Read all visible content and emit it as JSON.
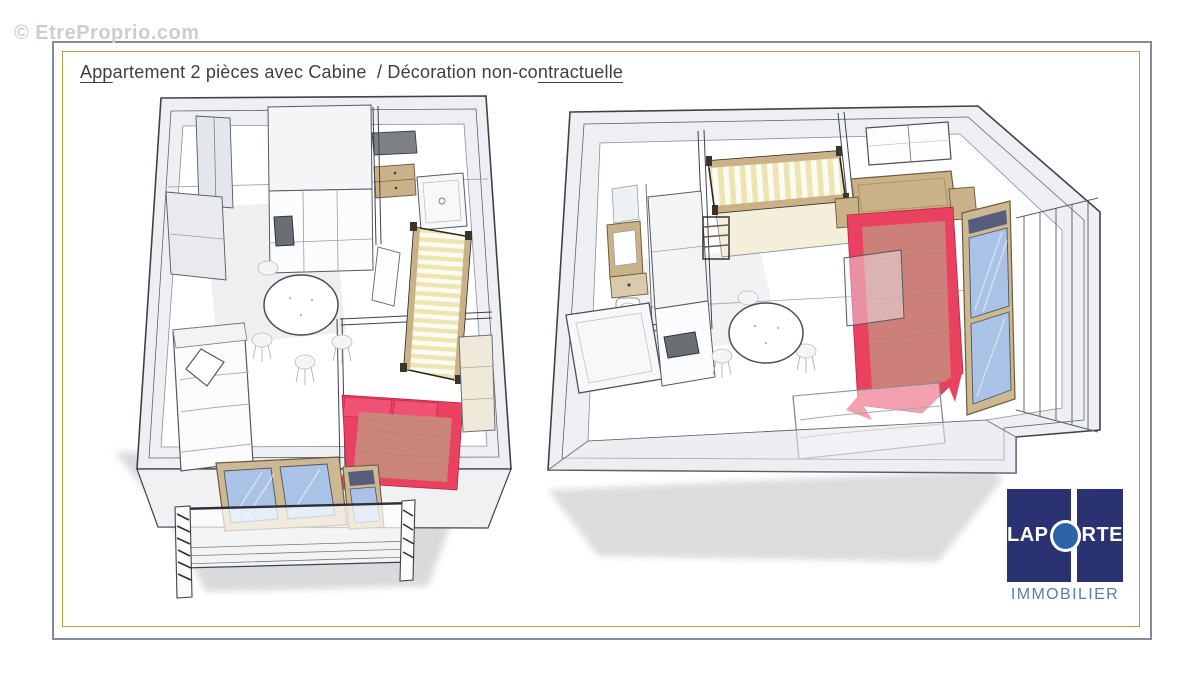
{
  "watermark": {
    "text": "© EtreProprio.com"
  },
  "header": {
    "title_underlined_start": "App",
    "title_middle": "artement 2 pièces avec Cabine  / Décoration non-co",
    "title_underlined_end": "ntractuelle"
  },
  "logo": {
    "word_left": "LAP",
    "word_right": "RTE",
    "subtitle": "IMMOBILIER"
  },
  "colors": {
    "frame_outer_gray": "#868c94",
    "frame_inner_gold": "#bf9b45",
    "watermark_gray": "#c9cdd6",
    "logo_navy": "#2b3272",
    "logo_circle_blue": "#2d64a8",
    "logo_subtitle_blue": "#5c7cab",
    "wall_fill": "#edeff2",
    "line_dark": "#3e434a",
    "bed_red": "#e9415f",
    "pillow_red": "#f05273",
    "duvet_muted": "#c6907f",
    "mattress_yellow": "#ece4b2",
    "wood_tan": "#c9b288",
    "window_frame_tan": "#cdb894",
    "glass_blue": "#a9c2e6",
    "shutter_navy": "#575c7c",
    "appliance_gray": "#6b6f74",
    "shadow_gray": "#d4d6d9"
  }
}
